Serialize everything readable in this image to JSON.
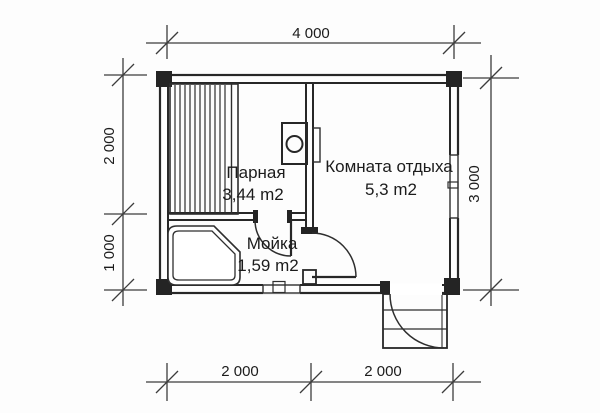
{
  "plan": {
    "type": "bath-house floor plan",
    "colors": {
      "background": "#fdfdfd",
      "line": "#272727",
      "text": "#1c1c1c"
    },
    "rooms": {
      "steam": {
        "name": "Парная",
        "area": "3,44 m2"
      },
      "rest": {
        "name": "Комната отдыха",
        "area": "5,3 m2"
      },
      "wash": {
        "name": "Мойка",
        "area": "1,59 m2"
      }
    },
    "dims": {
      "top": "4 000",
      "left_upper": "2 000",
      "left_lower": "1 000",
      "right": "3 000",
      "bottom_left": "2 000",
      "bottom_right": "2 000"
    },
    "icons": [
      "stove-icon",
      "bench-hatch",
      "shower-tray",
      "door-arc",
      "entrance-steps",
      "window"
    ]
  }
}
